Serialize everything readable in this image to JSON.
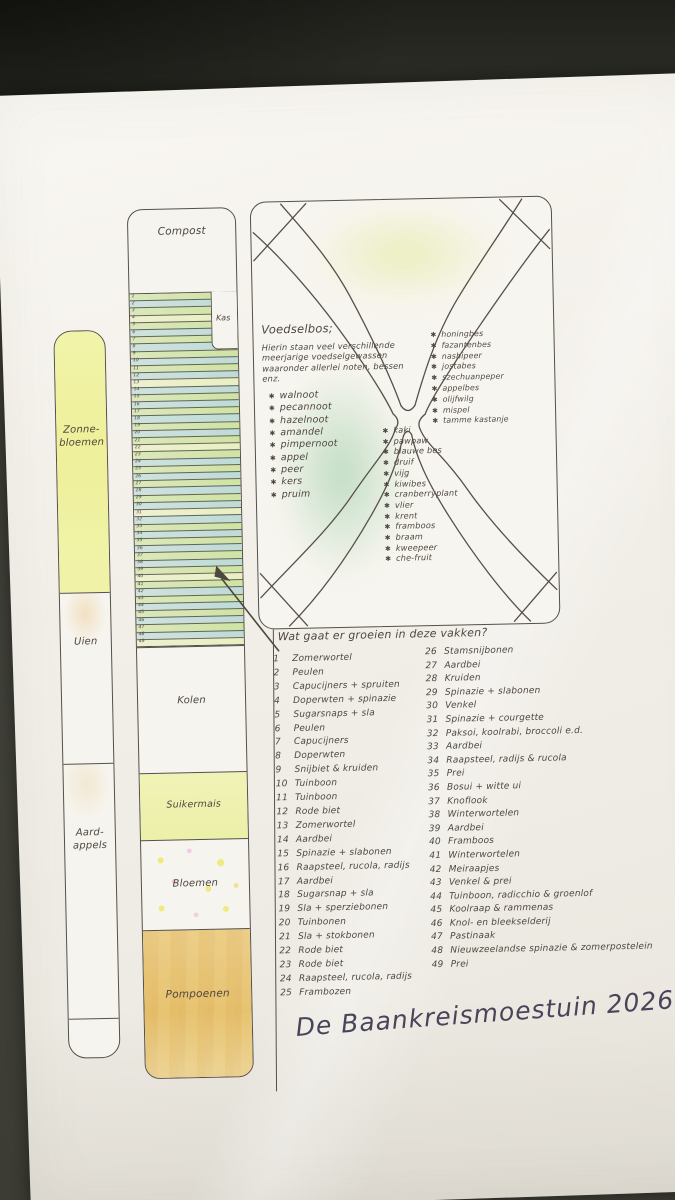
{
  "scene": {
    "title": "De Baankreismoestuin 2026"
  },
  "left_bed": {
    "sections": [
      {
        "label": "Zonne-\nbloemen"
      },
      {
        "label": "Uien"
      },
      {
        "label": "Aard-\nappels"
      }
    ]
  },
  "middle_bed": {
    "compost_label": "Compost",
    "kas_label": "Kas",
    "row_count": 49,
    "sections": [
      {
        "label": "Kolen"
      },
      {
        "label": "Suikermais"
      },
      {
        "label": "Bloemen"
      },
      {
        "label": "Pompoenen"
      }
    ]
  },
  "food_forest": {
    "title": "Voedselbos;",
    "intro": "Hierin staan veel verschillende meerjarige voedselgewassen waaronder allerlei noten, bessen enz.",
    "trees": [
      "walnoot",
      "pecannoot",
      "hazelnoot",
      "amandel",
      "pimpernoot",
      "appel",
      "peer",
      "kers",
      "pruim"
    ],
    "shrubs": [
      "honingbes",
      "fazantenbes",
      "nashipeer",
      "jostabes",
      "szechuanpeper",
      "appelbes",
      "olijfwilg",
      "mispel",
      "tamme kastanje"
    ],
    "berries": [
      "kaki",
      "pawpaw",
      "blauwe bes",
      "druif",
      "vijg",
      "kiwibes",
      "cranberryplant",
      "vlier",
      "krent",
      "framboos",
      "braam",
      "kweepeer",
      "che-fruit"
    ]
  },
  "plots": {
    "question": "Wat gaat er groeien in deze vakken?",
    "left_column": [
      {
        "n": "1",
        "t": "Zomerwortel"
      },
      {
        "n": "2",
        "t": "Peulen"
      },
      {
        "n": "3",
        "t": "Capucijners + spruiten"
      },
      {
        "n": "4",
        "t": "Doperwten + spinazie"
      },
      {
        "n": "5",
        "t": "Sugarsnaps + sla"
      },
      {
        "n": "6",
        "t": "Peulen"
      },
      {
        "n": "7",
        "t": "Capucijners"
      },
      {
        "n": "8",
        "t": "Doperwten"
      },
      {
        "n": "9",
        "t": "Snijbiet & kruiden"
      },
      {
        "n": "10",
        "t": "Tuinboon"
      },
      {
        "n": "11",
        "t": "Tuinboon"
      },
      {
        "n": "12",
        "t": "Rode biet"
      },
      {
        "n": "13",
        "t": "Zomerwortel"
      },
      {
        "n": "14",
        "t": "Aardbei"
      },
      {
        "n": "15",
        "t": "Spinazie + slabonen"
      },
      {
        "n": "16",
        "t": "Raapsteel, rucola, radijs"
      },
      {
        "n": "17",
        "t": "Aardbei"
      },
      {
        "n": "18",
        "t": "Sugarsnap + sla"
      },
      {
        "n": "19",
        "t": "Sla + sperziebonen"
      },
      {
        "n": "20",
        "t": "Tuinbonen"
      },
      {
        "n": "21",
        "t": "Sla + stokbonen"
      },
      {
        "n": "22",
        "t": "Rode biet"
      },
      {
        "n": "23",
        "t": "Rode biet"
      },
      {
        "n": "24",
        "t": "Raapsteel, rucola, radijs"
      },
      {
        "n": "25",
        "t": "Frambozen"
      }
    ],
    "right_column": [
      {
        "n": "26",
        "t": "Stamsnijbonen"
      },
      {
        "n": "27",
        "t": "Aardbei"
      },
      {
        "n": "28",
        "t": "Kruiden"
      },
      {
        "n": "29",
        "t": "Spinazie + slabonen"
      },
      {
        "n": "30",
        "t": "Venkel"
      },
      {
        "n": "31",
        "t": "Spinazie + courgette"
      },
      {
        "n": "32",
        "t": "Paksoi, koolrabi, broccoli e.d."
      },
      {
        "n": "33",
        "t": "Aardbei"
      },
      {
        "n": "34",
        "t": "Raapsteel, radijs & rucola"
      },
      {
        "n": "35",
        "t": "Prei"
      },
      {
        "n": "36",
        "t": "Bosui + witte ui"
      },
      {
        "n": "37",
        "t": "Knoflook"
      },
      {
        "n": "38",
        "t": "Winterwortelen"
      },
      {
        "n": "39",
        "t": "Aardbei"
      },
      {
        "n": "40",
        "t": "Framboos"
      },
      {
        "n": "41",
        "t": "Winterwortelen"
      },
      {
        "n": "42",
        "t": "Meiraapjes"
      },
      {
        "n": "43",
        "t": "Venkel & prei"
      },
      {
        "n": "44",
        "t": "Tuinboon, radicchio & groenlof"
      },
      {
        "n": "45",
        "t": "Koolraap & rammenas"
      },
      {
        "n": "46",
        "t": "Knol- en bleekselderij"
      },
      {
        "n": "47",
        "t": "Pastinaak"
      },
      {
        "n": "48",
        "t": "Nieuwzeelandse spinazie & zomerpostelein"
      },
      {
        "n": "49",
        "t": "Prei"
      }
    ]
  },
  "colors": {
    "paper": "#f3f0ea",
    "background": "#3a3a33",
    "ink": "#4e473f",
    "yellow_bed": "#eef09a",
    "green_row": "#cfe3a4",
    "blue_row": "#bedbd6",
    "pale_row": "#e9efc2",
    "maize": "#eef0a8",
    "pumpkin": "#e7c372",
    "forest_green": "#8cc698",
    "title_ink": "#49445a"
  }
}
